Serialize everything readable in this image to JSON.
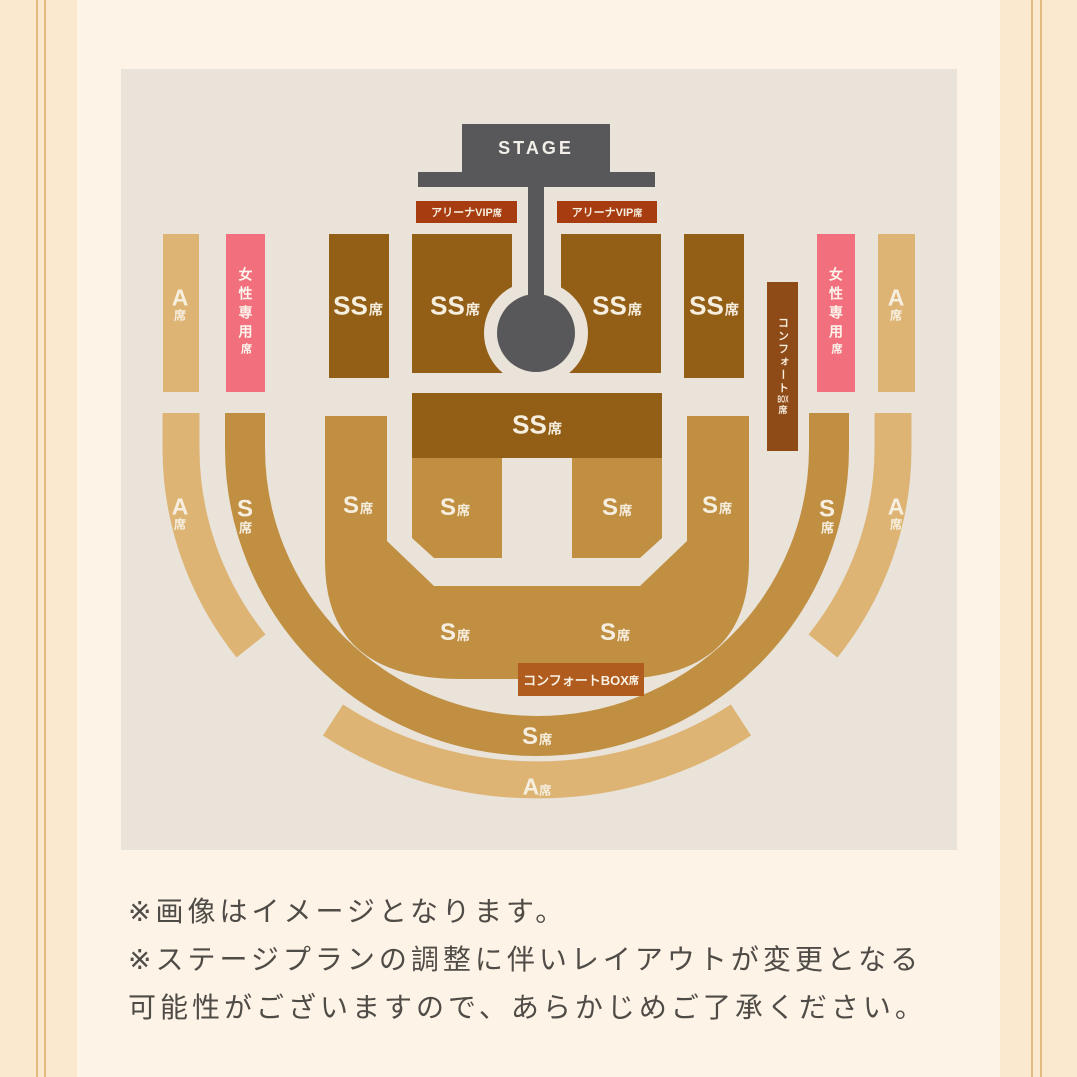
{
  "stage": {
    "label": "STAGE"
  },
  "seats": {
    "suffix": "席",
    "ss": "SS",
    "s": "S",
    "a": "A",
    "arena_vip": {
      "main": "アリーナVIP",
      "suffix": "席"
    },
    "women_only": {
      "main": "女性専用",
      "suffix": "席"
    },
    "comfort_strip": {
      "prefix": "コンフォート",
      "box": "BOX",
      "suffix": "席"
    },
    "comfort_box": {
      "main": "コンフォートBOX",
      "suffix": "席"
    }
  },
  "notes": {
    "lines": [
      "※画像はイメージとなります。",
      "※ステージプランの調整に伴いレイアウトが変更となる",
      "可能性がございますので、あらかじめご了承ください。"
    ]
  },
  "colors": {
    "page_background": "#fdf3e6",
    "side_band": "#fbe9cf",
    "pinstripe": "#e2bb80",
    "map_background": "#e9e3da",
    "stage": "#58585a",
    "ss_seat": "#935f17",
    "s_seat": "#c08f42",
    "a_seat": "#ddb474",
    "arena_vip": "#a63c10",
    "women_only": "#f2707d",
    "comfort_strip": "#8e4a17",
    "comfort_box_label": "#b05c1e",
    "seat_label_text": "#f6efe0",
    "note_text": "#4f4b47"
  }
}
